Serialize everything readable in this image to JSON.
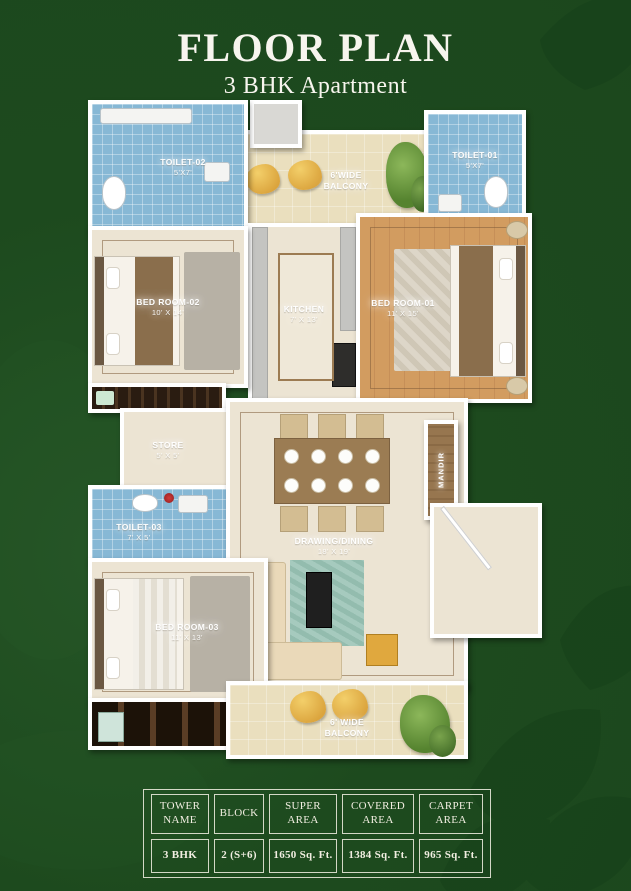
{
  "header": {
    "title": "FLOOR PLAN",
    "subtitle": "3 BHK Apartment"
  },
  "plan": {
    "rooms": {
      "toilet02": {
        "label": "TOILET-02",
        "dim": "5'X7'"
      },
      "toilet01": {
        "label": "TOILET-01",
        "dim": "5'X7'"
      },
      "balcony_top": {
        "line1": "6'WIDE",
        "line2": "BALCONY"
      },
      "bedroom02": {
        "label": "BED ROOM-02",
        "dim": "10' X 14'"
      },
      "kitchen": {
        "label": "KITCHEN",
        "dim": "7' X 13'"
      },
      "bedroom01": {
        "label": "BED ROOM-01",
        "dim": "11' X 15'"
      },
      "store": {
        "label": "STORE",
        "dim": "5' X 5'"
      },
      "toilet03": {
        "label": "TOILET-03",
        "dim": "7' X 5'"
      },
      "drawing": {
        "label": "DRAWING/DINING",
        "dim": "18' X 19'"
      },
      "mandir": {
        "label": "MANDIR"
      },
      "bedroom03": {
        "label": "BED ROOM-03",
        "dim": "11' X 13'"
      },
      "balcony_bottom": {
        "line1": "6' WIDE",
        "line2": "BALCONY"
      }
    }
  },
  "table": {
    "headers": [
      "TOWER NAME",
      "BLOCK",
      "SUPER AREA",
      "COVERED AREA",
      "CARPET AREA"
    ],
    "values": [
      "3 BHK",
      "2 (S+6)",
      "1650 Sq. Ft.",
      "1384 Sq. Ft.",
      "965 Sq. Ft."
    ]
  },
  "colors": {
    "background": "#1d4a1e",
    "leaf": "#16401a",
    "wall": "#ffffff",
    "tile_blue": "#87b8d5",
    "floor_cream": "#ece4d3",
    "floor_wood": "#d29c60",
    "balcony_floor": "#eadfbe",
    "accent_yellow": "#e9b94d",
    "plant_green": "#5d8f3c",
    "wardrobe_dark": "#33241a",
    "rug_teal": "#a6cabe"
  }
}
